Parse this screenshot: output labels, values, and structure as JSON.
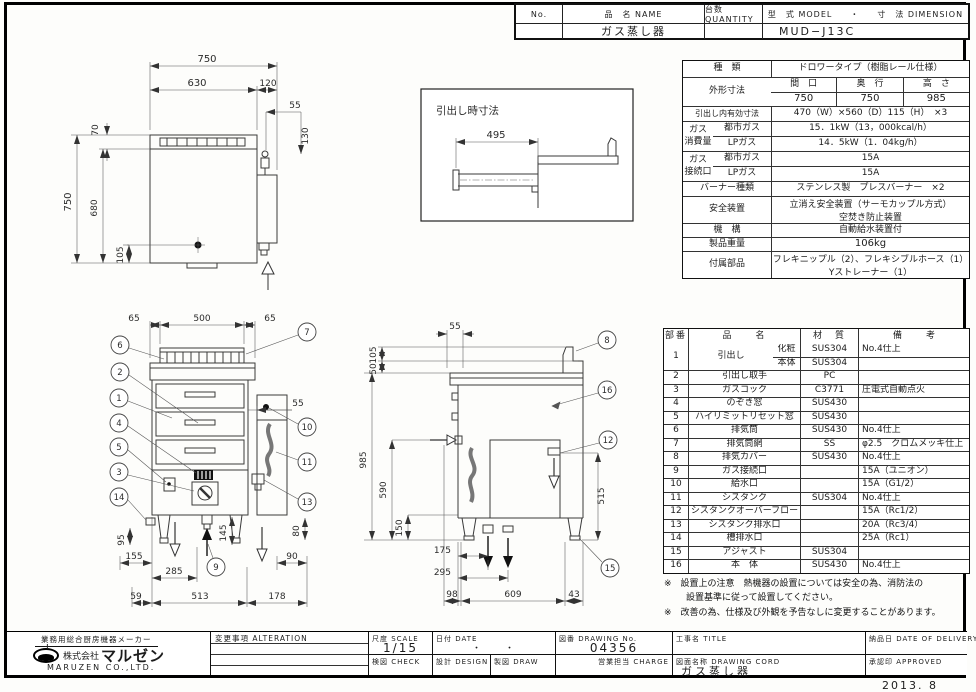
{
  "header": {
    "no_label": "No.",
    "name_label": "品　名 NAME",
    "qty_label": "台数 QUANTITY",
    "model_dim_label": "型　式 MODEL　　・　　寸　法 DIMENSION",
    "name_value": "ガス蒸し器",
    "model_value": "MUD−J13C"
  },
  "spec": {
    "kind_label": "種　類",
    "kind_value": "ドロワータイプ（樹脂レール仕様）",
    "outer_label": "外形寸法",
    "width_label": "間　口",
    "depth_label": "奥　行",
    "height_label": "高　さ",
    "width_value": "750",
    "depth_value": "750",
    "height_value": "985",
    "drawer_label": "引出し内有効寸法",
    "drawer_value": "470（W）×560（D）115（H）　×3",
    "gas_use_label": "ガス消費量",
    "city_gas_label": "都市ガス",
    "lp_gas_label": "LPガス",
    "city_gas_value": "15．1kW（13，000kcal/h）",
    "lp_gas_value": "14．5kW（1．04kg/h）",
    "gas_conn_label": "ガス接続口",
    "conn_city_label": "都市ガス",
    "conn_lp_label": "LPガス",
    "conn_city_value": "15A",
    "conn_lp_value": "15A",
    "burner_label": "バーナー種類",
    "burner_value": "ステンレス製　プレスバーナー　×2",
    "safety_label": "安全装置",
    "safety_value1": "立消え安全装置（サーモカップル方式）",
    "safety_value2": "空焚き防止装置",
    "mech_label": "機　構",
    "mech_value": "自動給水装置付",
    "weight_label": "製品重量",
    "weight_value": "106kg",
    "accessory_label": "付属部品",
    "accessory_value1": "フレキニップル（2）、フレキシブルホース（1）",
    "accessory_value2": "Yストレーナー（1）"
  },
  "parts": {
    "no_label": "部番",
    "name_label": "品　　名",
    "material_label": "材　質",
    "note_label": "備　　考",
    "rows": [
      {
        "no": "1",
        "name": "引出し",
        "subs": [
          {
            "label": "化粧",
            "material": "SUS304",
            "note": "No.4仕上"
          },
          {
            "label": "本体",
            "material": "SUS304",
            "note": ""
          }
        ]
      },
      {
        "no": "2",
        "name": "引出し取手",
        "material": "PC",
        "note": ""
      },
      {
        "no": "3",
        "name": "ガスコック",
        "material": "C3771",
        "note": "圧電式自動点火"
      },
      {
        "no": "4",
        "name": "のぞき窓",
        "material": "SUS430",
        "note": ""
      },
      {
        "no": "5",
        "name": "ハイリミットリセット窓",
        "material": "SUS430",
        "note": ""
      },
      {
        "no": "6",
        "name": "排気筒",
        "material": "SUS430",
        "note": "No.4仕上"
      },
      {
        "no": "7",
        "name": "排気筒網",
        "material": "SS",
        "note": "φ2.5　クロムメッキ仕上"
      },
      {
        "no": "8",
        "name": "排気カバー",
        "material": "SUS430",
        "note": "No.4仕上"
      },
      {
        "no": "9",
        "name": "ガス接続口",
        "material": "",
        "note": "15A（ユニオン）"
      },
      {
        "no": "10",
        "name": "給水口",
        "material": "",
        "note": "15A（G1/2）"
      },
      {
        "no": "11",
        "name": "シスタンク",
        "material": "SUS304",
        "note": "No.4仕上"
      },
      {
        "no": "12",
        "name": "シスタンクオーバーフロー",
        "material": "",
        "note": "15A（Rc1/2）"
      },
      {
        "no": "13",
        "name": "シスタンク排水口",
        "material": "",
        "note": "20A（Rc3/4）"
      },
      {
        "no": "14",
        "name": "槽排水口",
        "material": "",
        "note": "25A（Rc1）"
      },
      {
        "no": "15",
        "name": "アジャスト",
        "material": "SUS304",
        "note": ""
      },
      {
        "no": "16",
        "name": "本　体",
        "material": "SUS430",
        "note": "No.4仕上"
      }
    ]
  },
  "notes": {
    "line1": "※　設置上の注意　熱機器の設置については安全の為、消防法の",
    "line2": "設置基準に従って設置してください。",
    "line3": "※　改善の為、仕様及び外観を予告なしに変更することがあります。"
  },
  "titleblock": {
    "maker_tagline": "業務用総合厨房機器メーカー",
    "company_prefix": "株式会社",
    "company_name": "マルゼン",
    "company_en": "MARUZEN CO.,LTD.",
    "alteration_label": "変更事項 ALTERATION",
    "scale_label": "尺度 SCALE",
    "scale_value": "1/15",
    "date_label": "日付 DATE",
    "date_value": "・　　・",
    "drawing_no_label": "図番 DRAWING No.",
    "drawing_no_value": "04356",
    "title_label": "工事名 TITLE",
    "check_label": "検図 CHECK",
    "design_label": "設計 DESIGN",
    "draw_label": "製図 DRAW",
    "charge_label": "営業担当 CHARGE",
    "drawing_name_label": "図面名称 DRAWING CORD",
    "drawing_name_value": "ガス蒸し器",
    "delivery_label": "納品日 DATE OF DELIVERY",
    "approved_label": "承認印 APPROVED",
    "issue_date": "2013. 8"
  },
  "drawings": {
    "plan": {
      "d750_top": "750",
      "d630": "630",
      "d120": "120",
      "d55": "55",
      "d70": "70",
      "d750_left": "750",
      "d680": "680",
      "d105": "105",
      "d130": "130"
    },
    "detail": {
      "title": "引出し時寸法",
      "d495": "495"
    },
    "front": {
      "d65_left": "65",
      "d500": "500",
      "d65_right": "65",
      "d55": "55",
      "d95": "95",
      "d155": "155",
      "d145": "145",
      "d80": "80",
      "d90": "90",
      "d285": "285",
      "d59": "59",
      "d513": "513",
      "d178": "178",
      "balloons": {
        "b1": "1",
        "b2": "2",
        "b3": "3",
        "b4": "4",
        "b5": "5",
        "b6": "6",
        "b7": "7",
        "b9": "9",
        "b10": "10",
        "b11": "11",
        "b13": "13",
        "b14": "14"
      }
    },
    "side": {
      "d105": "105",
      "d50": "50",
      "d55": "55",
      "d985": "985",
      "d590": "590",
      "d150": "150",
      "d515": "515",
      "d175": "175",
      "d295": "295",
      "d98": "98",
      "d609": "609",
      "d43": "43",
      "balloons": {
        "b8": "8",
        "b12": "12",
        "b15": "15",
        "b16": "16"
      }
    }
  }
}
